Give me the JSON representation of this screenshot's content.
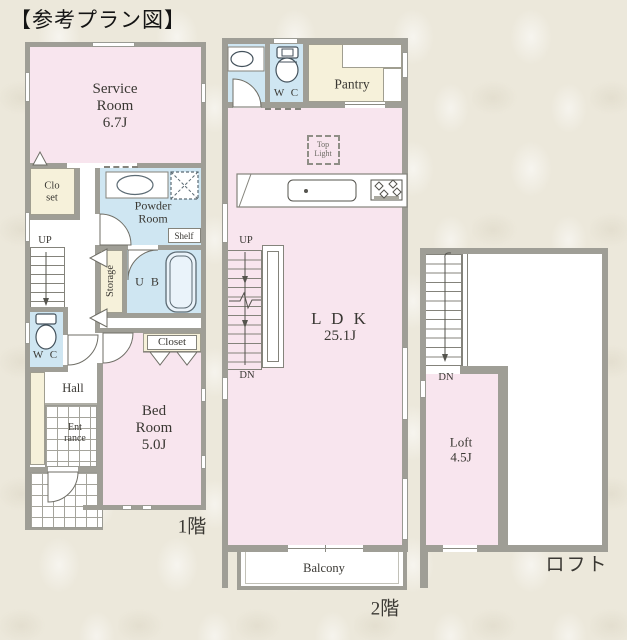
{
  "title": "【参考プラン図】",
  "colors": {
    "room_pink": "#f8e5ee",
    "wet_area_blue": "#cfe6f2",
    "closet_cream": "#f6f1da",
    "wall_gray": "#9f9e96",
    "background_beige": "#ece8db"
  },
  "floor1": {
    "floor_label": "1階",
    "service_room": {
      "line1": "Service",
      "line2": "Room",
      "size": "6.7J"
    },
    "closet_upper": {
      "line1": "Clo",
      "line2": "set"
    },
    "powder_room": {
      "line1": "Powder",
      "line2": "Room"
    },
    "shelf": "Shelf",
    "storage": "Storage",
    "unit_bath": "U B",
    "up": "UP",
    "wc": "W C",
    "closet": "Closet",
    "hall": "Hall",
    "entrance": {
      "line1": "Ent",
      "line2": "rance"
    },
    "bed_room": {
      "line1": "Bed",
      "line2": "Room",
      "size": "5.0J"
    }
  },
  "floor2": {
    "floor_label": "2階",
    "wc": "W C",
    "pantry": "Pantry",
    "top_light": {
      "line1": "Top",
      "line2": "Light"
    },
    "ldk": {
      "name": "L D K",
      "size": "25.1J"
    },
    "up": "UP",
    "dn": "DN",
    "balcony": "Balcony"
  },
  "loft": {
    "floor_label": "ロフト",
    "dn": "DN",
    "loft_room": {
      "name": "Loft",
      "size": "4.5J"
    }
  }
}
